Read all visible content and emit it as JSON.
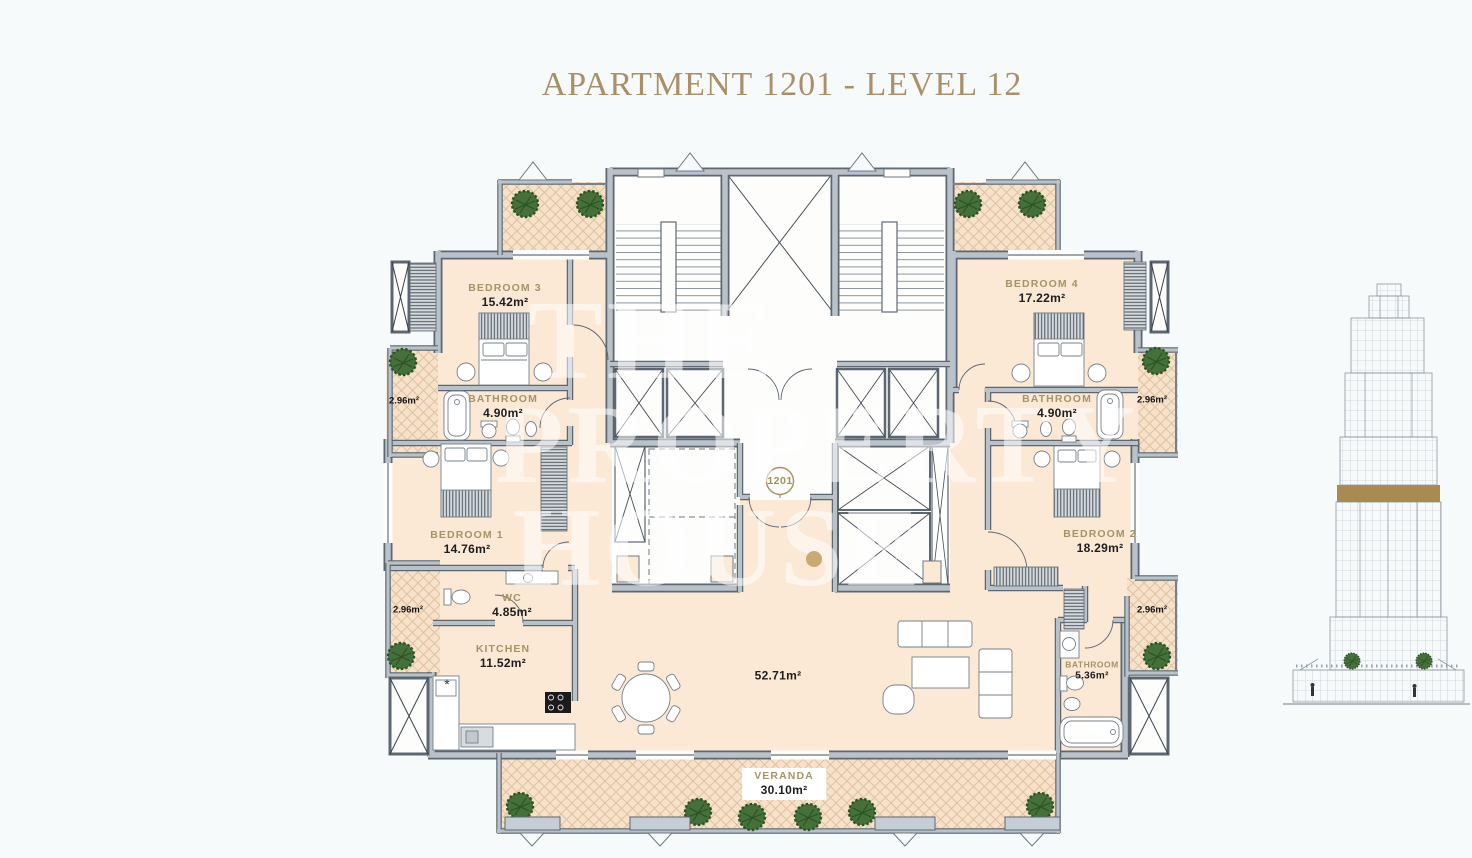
{
  "title": "APARTMENT 1201 - LEVEL 12",
  "unit": {
    "badge": "1201"
  },
  "watermark": {
    "line1": "THE",
    "line2": "PROPERTY",
    "line3": "HOUSE"
  },
  "rooms": {
    "bedroom3": {
      "name": "BEDROOM 3",
      "area": "15.42m²"
    },
    "bathroom3": {
      "name": "BATHROOM",
      "area": "4.90m²"
    },
    "bedroom1": {
      "name": "BEDROOM 1",
      "area": "14.76m²"
    },
    "wc": {
      "name": "WC",
      "area": "4.85m²"
    },
    "kitchen": {
      "name": "KITCHEN",
      "area": "11.52m²",
      "sink_mark": "*"
    },
    "living": {
      "area": "52.71m²"
    },
    "bedroom4": {
      "name": "BEDROOM 4",
      "area": "17.22m²"
    },
    "bathroom4": {
      "name": "BATHROOM",
      "area": "4.90m²"
    },
    "bedroom2": {
      "name": "BEDROOM 2",
      "area": "18.29m²"
    },
    "bathroom2": {
      "name": "BATHROOM",
      "area": "5.36m²"
    },
    "veranda": {
      "name": "VERANDA",
      "area": "30.10m²"
    },
    "balcony": {
      "area": "2.96m²"
    }
  },
  "colors": {
    "accent_gold": "#aa9068",
    "floor": "#fbe8d5",
    "balcony_floor": "#f7e2c9",
    "wall": "#b9c1c9",
    "wall_dark": "#5d6771",
    "tree": "#44703a",
    "elevation_band": "#a98b52",
    "background": "#f6fafa"
  }
}
